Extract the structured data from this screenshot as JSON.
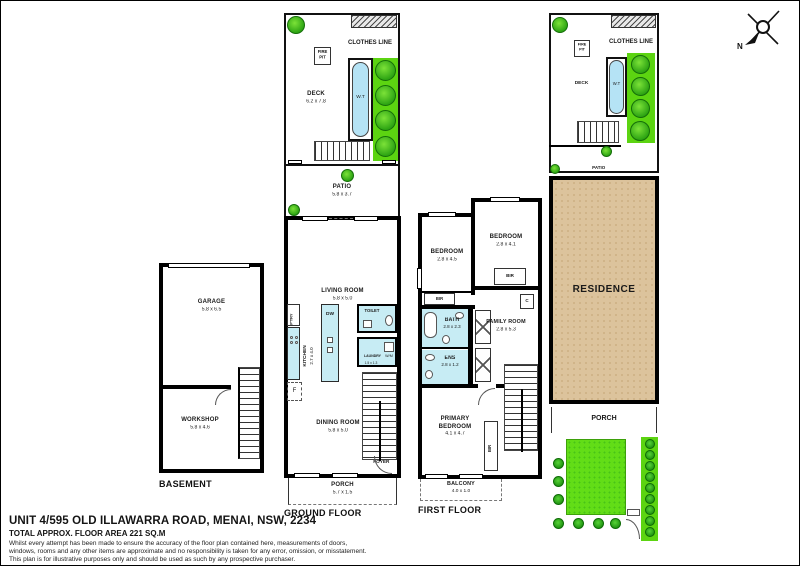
{
  "meta": {
    "address": "UNIT 4/595 OLD ILLAWARRA ROAD, MENAI, NSW, 2234",
    "area": "TOTAL APPROX. FLOOR AREA 221 SQ.M",
    "disc1": "Whilst every attempt has been made to ensure the accuracy of the floor plan contained here, measurements of doors,",
    "disc2": "windows, rooms and any other items are approximate and no responsibility is taken for any error, omission, or misstatement.",
    "disc3": "This plan is for illustrative purposes only and should be used as such by any prospective purchaser."
  },
  "compass": {
    "n": "N"
  },
  "basement": {
    "title": "BASEMENT",
    "garage": "GARAGE",
    "garage_dims": "5.8 x 6.5",
    "workshop": "WORKSHOP",
    "workshop_dims": "5.8 x 4.6"
  },
  "ground": {
    "title": "GROUND FLOOR",
    "clothes": "CLOTHES LINE",
    "firepit": "FIRE PIT",
    "deck": "DECK",
    "deck_dims": "6.2 x 7.8",
    "wt": "W.T",
    "patio": "PATIO",
    "patio_dims": "5.8 x 3.7",
    "living": "LIVING ROOM",
    "living_dims": "5.8 x 5.0",
    "pantry": "P'TRY",
    "kitchen": "KITCHEN",
    "kitchen_dims": "2.7 x 4.0",
    "dw": "DW",
    "fridge": "F",
    "toilet": "TOILET",
    "laundry": "LAUNDRY",
    "wm": "W/M",
    "laundry_dims": "1.5 x 1.3",
    "dining": "DINING ROOM",
    "dining_dims": "5.8 x 5.0",
    "foyer": "FOYER",
    "porch": "PORCH",
    "porch_dims": "5.7 x 1.5"
  },
  "first": {
    "title": "FIRST FLOOR",
    "bedroom": "BEDROOM",
    "bed_left_dims": "2.8 x 4.5",
    "bed_right_dims": "2.8 x 4.1",
    "bir": "BIR",
    "closet": "C",
    "bath": "BATH",
    "bath_dims": "2.8 x 2.3",
    "family": "FAMILY ROOM",
    "family_dims": "2.8 x 5.3",
    "ens": "ENS",
    "ens_dims": "2.8 x 1.2",
    "primary": "PRIMARY BEDROOM",
    "primary_dims": "4.1 x 4.7",
    "balcony": "BALCONY",
    "balcony_dims": "4.0 x 1.0"
  },
  "site": {
    "clothes": "CLOTHES LINE",
    "firepit": "FIRE PIT",
    "deck": "DECK",
    "wt": "W.T",
    "patio": "PATIO",
    "residence": "RESIDENCE",
    "porch": "PORCH"
  },
  "colors": {
    "wall": "#000000",
    "wet": "#c7ecf4",
    "tree": "#2ca313",
    "lawn": "#62dd17",
    "residence_fill": "#dcc39c"
  }
}
